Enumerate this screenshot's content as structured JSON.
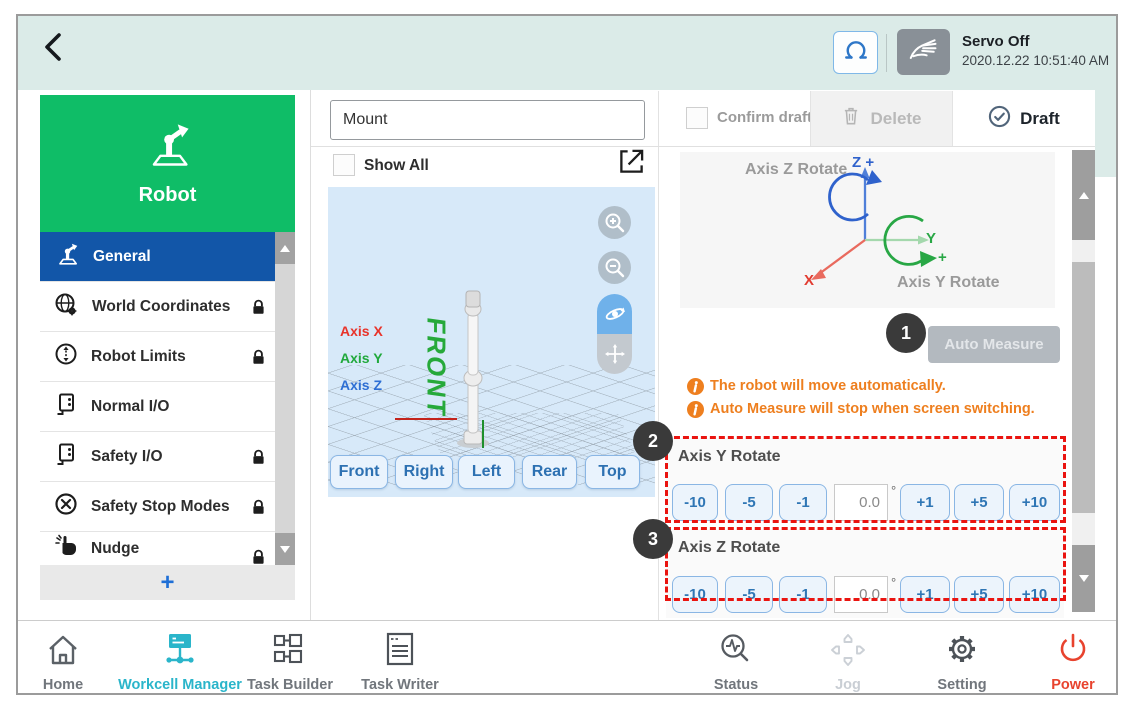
{
  "window": {
    "servo_status": "Servo Off",
    "timestamp": "2020.12.22 10:51:40 AM"
  },
  "sidebar": {
    "title": "Robot",
    "items": [
      {
        "label": "General",
        "active": true,
        "locked": false
      },
      {
        "label": "World Coordinates",
        "locked": true
      },
      {
        "label": "Robot Limits",
        "locked": true
      },
      {
        "label": "Normal I/O",
        "locked": false
      },
      {
        "label": "Safety I/O",
        "locked": true
      },
      {
        "label": "Safety Stop Modes",
        "locked": true
      },
      {
        "label": "Nudge",
        "locked": true
      }
    ],
    "add_button_label": "+"
  },
  "toolbar": {
    "name_value": "Mount",
    "confirm_draft_label": "Confirm draft",
    "delete_label": "Delete",
    "draft_label": "Draft"
  },
  "viewer": {
    "show_all_label": "Show All",
    "axis_x_label": "Axis X",
    "axis_y_label": "Axis Y",
    "axis_z_label": "Axis Z",
    "floor_marker": "FRONT",
    "view_buttons": [
      "Front",
      "Right",
      "Left",
      "Rear",
      "Top"
    ]
  },
  "measure_panel": {
    "diagram": {
      "axis_z_rotate_label": "Axis Z Rotate",
      "axis_y_rotate_label": "Axis Y Rotate",
      "z_axis_label": "Z +",
      "y_axis_label": "Y",
      "y_plus_label": "+",
      "x_axis_label": "X"
    },
    "step1_badge": "1",
    "step2_badge": "2",
    "step3_badge": "3",
    "auto_measure_label": "Auto Measure",
    "notes": [
      "The robot will move automatically.",
      "Auto Measure will stop when screen switching."
    ],
    "sections": [
      {
        "title": "Axis Y Rotate",
        "dec_buttons": [
          "-10",
          "-5",
          "-1"
        ],
        "value": "0.0",
        "unit": "°",
        "inc_buttons": [
          "+1",
          "+5",
          "+10"
        ]
      },
      {
        "title": "Axis Z Rotate",
        "dec_buttons": [
          "-10",
          "-5",
          "-1"
        ],
        "value": "0.0",
        "unit": "°",
        "inc_buttons": [
          "+1",
          "+5",
          "+10"
        ]
      }
    ]
  },
  "nav": {
    "items": [
      {
        "label": "Home"
      },
      {
        "label": "Workcell Manager",
        "state": "active"
      },
      {
        "label": "Task Builder"
      },
      {
        "label": "Task Writer"
      },
      {
        "label": "Status"
      },
      {
        "label": "Jog",
        "state": "disabled"
      },
      {
        "label": "Setting"
      },
      {
        "label": "Power",
        "state": "power"
      }
    ]
  },
  "colors": {
    "header_background": "#dbebe8",
    "brand_green": "#0fbd67",
    "active_blue": "#1256a8",
    "accent_teal": "#2ab5ca",
    "jog_button_blue": "#2f76b5",
    "highlight_dashed_red": "#ea1410",
    "notice_orange": "#ee7f1f",
    "power_red": "#e8432e"
  }
}
